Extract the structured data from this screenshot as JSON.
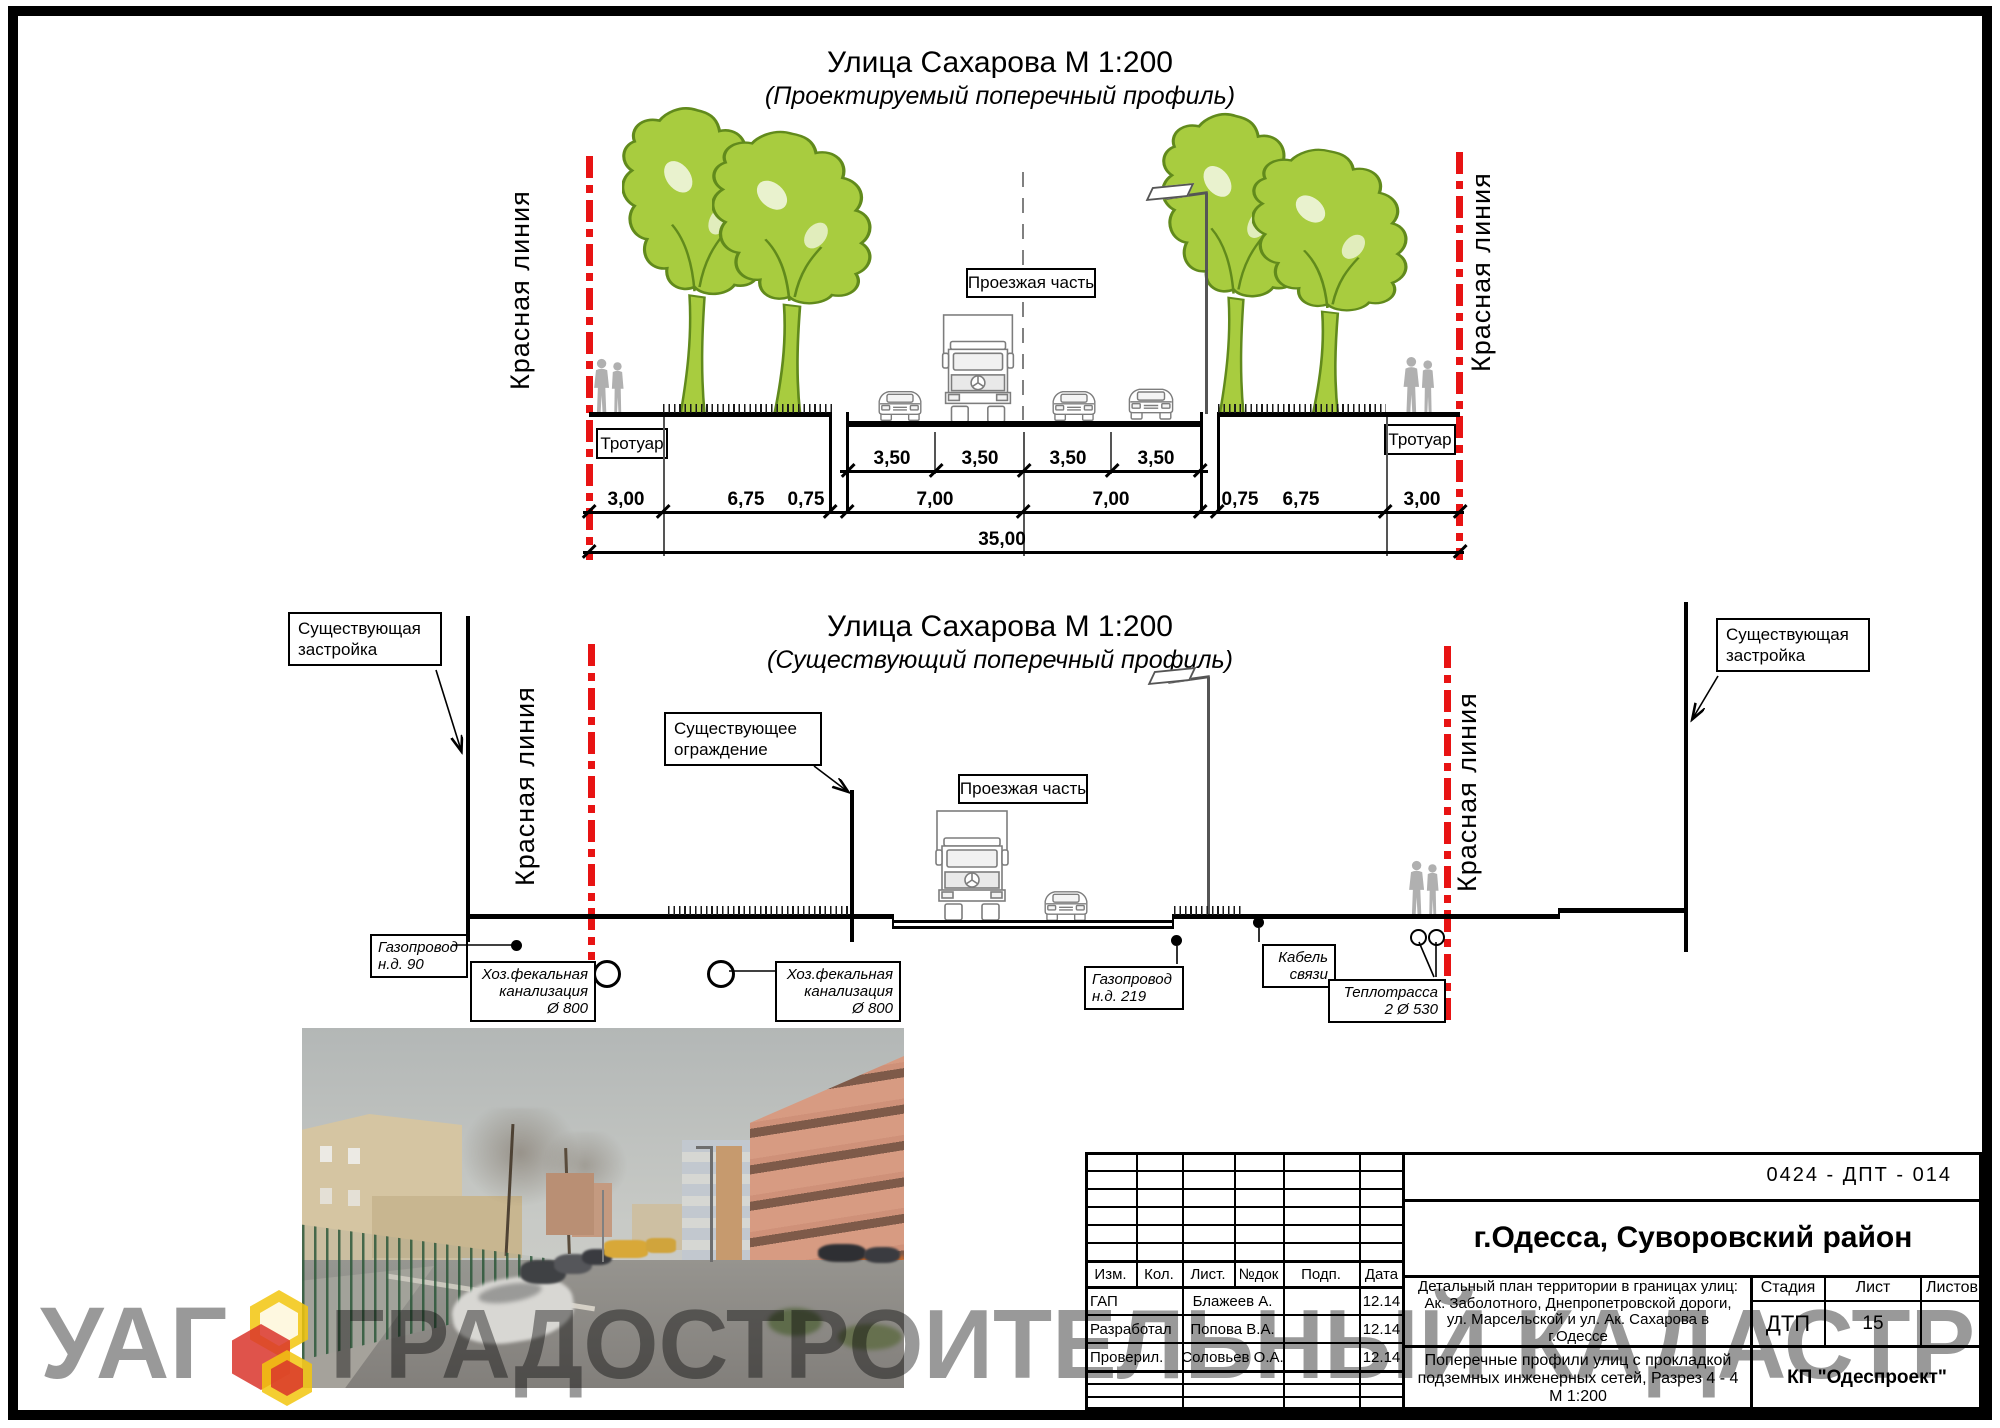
{
  "proposed_profile": {
    "title": "Улица Сахарова М 1:200",
    "subtitle": "(Проектируемый поперечный профиль)",
    "red_line_left": "Красная линия",
    "red_line_right": "Красная линия",
    "sidewalk_left": "Тротуар",
    "sidewalk_right": "Тротуар",
    "roadway": "Проезжая часть",
    "lane_dims": [
      "3,50",
      "3,50",
      "3,50",
      "3,50"
    ],
    "main_dims": [
      "3,00",
      "6,75",
      "0,75",
      "7,00",
      "7,00",
      "0,75",
      "6,75",
      "3,00"
    ],
    "total_dim": "35,00"
  },
  "existing_profile": {
    "title": "Улица Сахарова М 1:200",
    "subtitle": "(Существующий поперечный профиль)",
    "red_line_left": "Красная линия",
    "red_line_right": "Красная линия",
    "roadway": "Проезжая часть",
    "building_left_lines": [
      "Существующая",
      "застройка"
    ],
    "building_right_lines": [
      "Существующая",
      "застройка"
    ],
    "fence_lines": [
      "Существующее",
      "ограждение"
    ],
    "utilities": {
      "gas90": [
        "Газопровод",
        "н.д. 90"
      ],
      "sewer_left": [
        "Хоз.фекальная",
        "канализация",
        "Ø 800"
      ],
      "sewer_right": [
        "Хоз.фекальная",
        "канализация",
        "Ø 800"
      ],
      "gas219": [
        "Газопровод",
        "н.д. 219"
      ],
      "cable": [
        "Кабель",
        "связи"
      ],
      "heat": [
        "Теплотрасса",
        "2 Ø 530"
      ]
    }
  },
  "title_block": {
    "doc_code": "0424 - ДПТ - 014",
    "city": "г.Одесса, Суворовский район",
    "columns": [
      "Изм.",
      "Кол.",
      "Лист.",
      "№док",
      "Подп.",
      "Дата"
    ],
    "signature_rows": [
      {
        "role": "ГАП",
        "name": "Блажеев А.",
        "sign": "",
        "date": "12.14"
      },
      {
        "role": "Разработал",
        "name": "Попова В.А.",
        "sign": "",
        "date": "12.14"
      },
      {
        "role": "Проверил.",
        "name": "Соловьев О.А.",
        "sign": "",
        "date": "12.14"
      }
    ],
    "project_lines": [
      "Детальный план территории в границах улиц:",
      "Ак. Заболотного, Днепропетровской дороги,",
      "ул. Марсельской и ул. Ак. Сахарова  в",
      "г.Одессе"
    ],
    "stage_label": "Стадия",
    "sheet_label": "Лист",
    "sheets_label": "Листов",
    "stage_value": "ДТП",
    "sheet_value": "15",
    "sheets_value": "",
    "drawing_title_lines": [
      "Поперечные профили улиц с прокладкой",
      "подземных инженерных сетей, Разрез 4 - 4",
      "М 1:200"
    ],
    "company": "КП \"Одеспроект\""
  },
  "watermark": {
    "left": "УАГ",
    "right": "ГРАДОСТРОИТЕЛЬНЫЙ КАДАСТР"
  },
  "colors": {
    "red_line": "#e81313",
    "tree_fill": "#a8cc3f",
    "tree_stroke": "#618a1c",
    "silhouette": "#b0b0b0",
    "vehicle_outline": "#7d7d7d",
    "watermark_gray": "#999999",
    "logo_yellow": "#f2c50e",
    "logo_red": "#d9352b"
  }
}
